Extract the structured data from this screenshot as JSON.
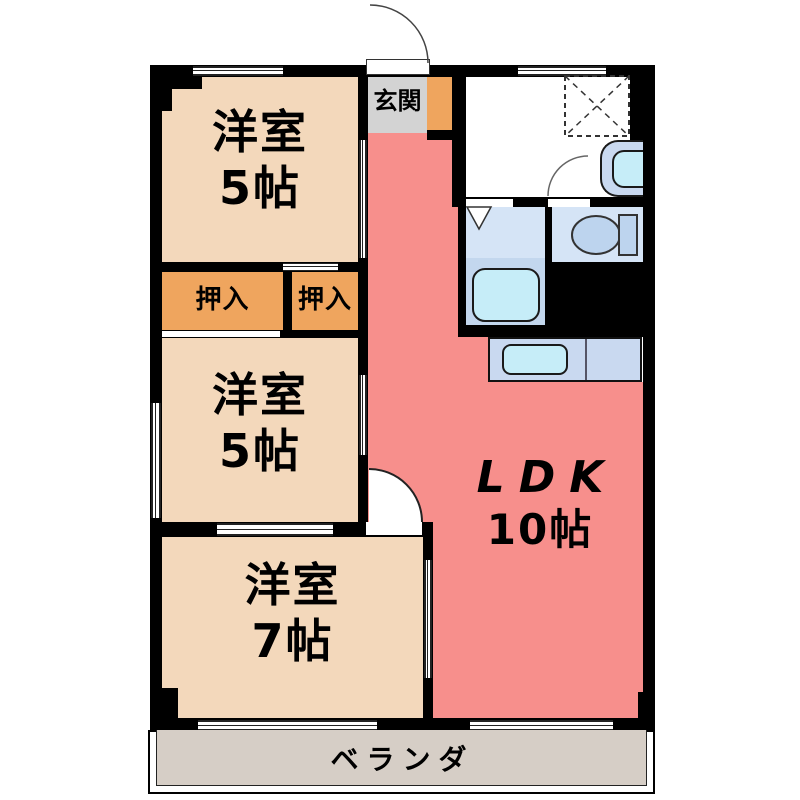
{
  "floorplan": {
    "type": "apartment-floor-plan",
    "rooms": {
      "room_top": {
        "name": "洋室",
        "size": "5帖"
      },
      "room_mid": {
        "name": "洋室",
        "size": "5帖"
      },
      "room_bottom": {
        "name": "洋室",
        "size": "7帖"
      },
      "ldk": {
        "name": "LDK",
        "size": "10帖"
      },
      "entrance": {
        "name": "玄関"
      },
      "closet_left": {
        "name": "押入"
      },
      "closet_right": {
        "name": "押入"
      },
      "veranda": {
        "name": "ベランダ"
      }
    },
    "fixtures": [
      "refrigerator-space-dashed",
      "washbasin",
      "toilet",
      "bathtub",
      "kitchen-counter-sink"
    ],
    "colors": {
      "room_beige": "#f3d8bb",
      "closet_orange": "#efa55e",
      "ldk_salmon": "#f78f8c",
      "entrance_gray": "#d3d3d3",
      "wet_area_blue": "#d5e4f6",
      "fixture_blue": "#c9d9f0",
      "water_cyan": "#c6edf8",
      "toilet_blue": "#bdd4ee",
      "veranda_gray": "#d6cec6",
      "wall_black": "#000000"
    }
  }
}
